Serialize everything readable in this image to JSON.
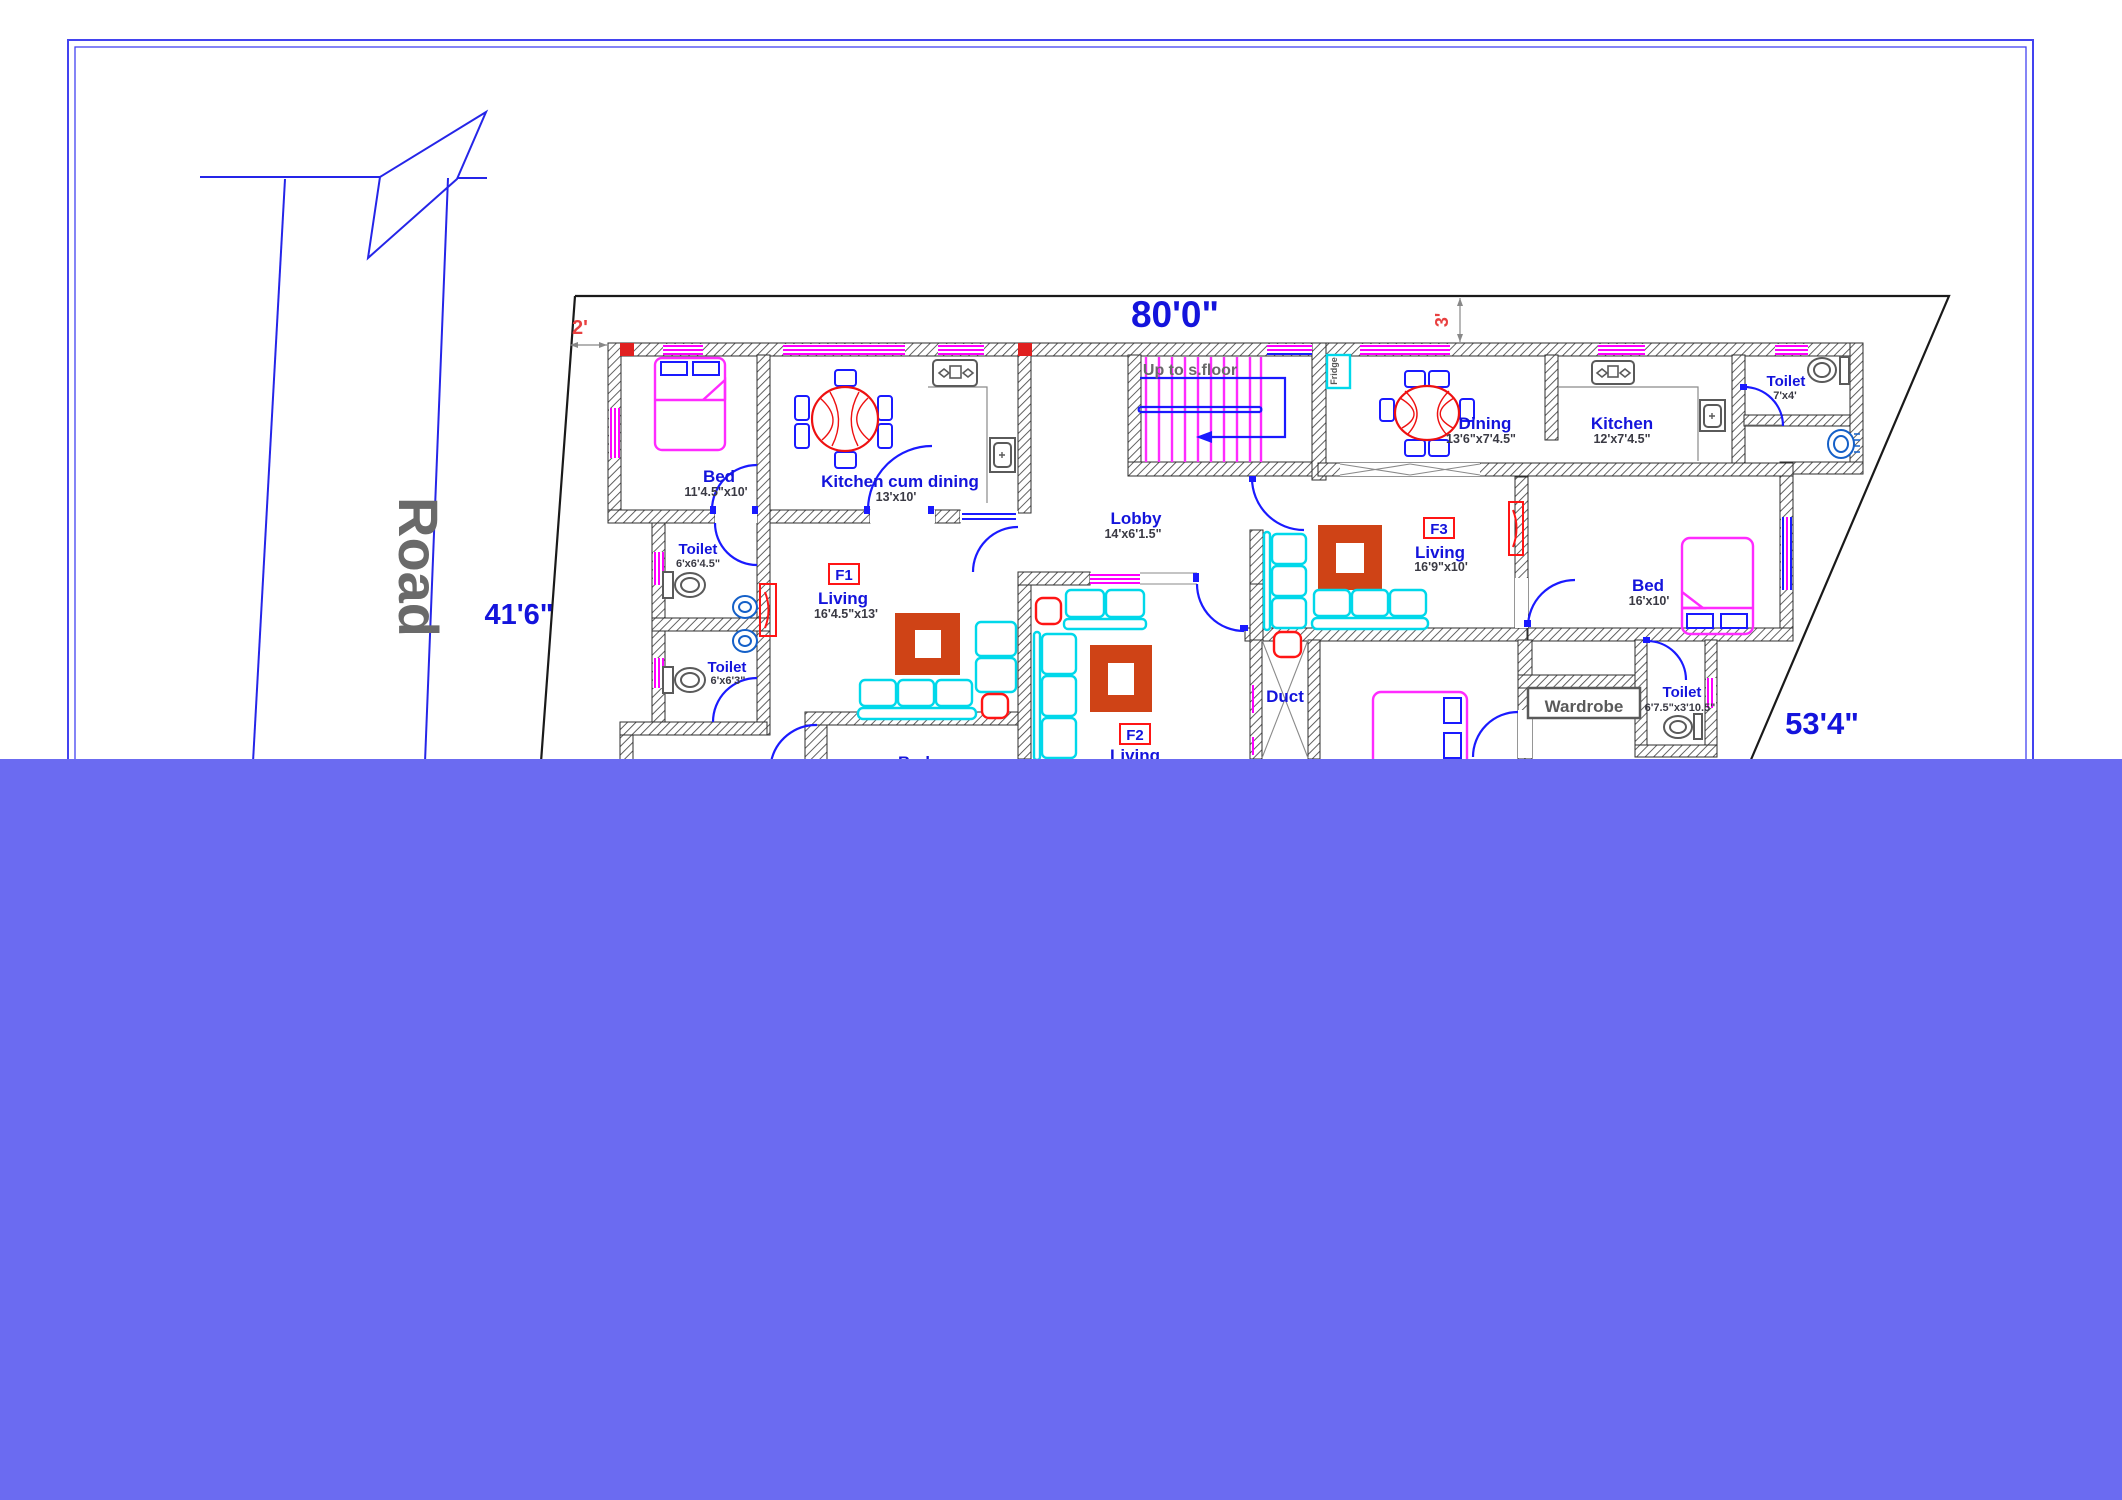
{
  "drawing": {
    "type": "architectural-floor-plan",
    "road_label": "Road",
    "stair_label": "Up to s.floor"
  },
  "dimensions": {
    "plot_top": "80'0\"",
    "plot_left": "41'6\"",
    "plot_right": "53'4\"",
    "setback_left": "2'",
    "setback_top": "3'"
  },
  "flats": {
    "f1": "F1",
    "f2": "F2",
    "f3": "F3"
  },
  "rooms": {
    "bed1": {
      "name": "Bed",
      "size": "11'4.5\"x10'"
    },
    "toilet1": {
      "name": "Toilet",
      "size": "6'x6'4.5\""
    },
    "toilet2": {
      "name": "Toilet",
      "size": "6'x6'3\""
    },
    "kitchen_cum_dining": {
      "name": "Kitchen cum dining",
      "size": "13'x10'"
    },
    "living_f1": {
      "name": "Living",
      "size": "16'4.5\"x13'"
    },
    "lobby": {
      "name": "Lobby",
      "size": "14'x6'1.5\""
    },
    "living_f2": {
      "name": "Living"
    },
    "dining": {
      "name": "Dining",
      "size": "13'6\"x7'4.5\""
    },
    "kitchen": {
      "name": "Kitchen",
      "size": "12'x7'4.5\""
    },
    "toilet3": {
      "name": "Toilet",
      "size": "7'x4'"
    },
    "bed2": {
      "name": "Bed",
      "size": "16'x10'"
    },
    "living_f3": {
      "name": "Living",
      "size": "16'9\"x10'"
    },
    "duct": {
      "name": "Duct"
    },
    "wardrobe": {
      "name": "Wardrobe"
    },
    "toilet4": {
      "name": "Toilet",
      "size": "6'7.5\"x3'10.5\""
    },
    "bed3": {
      "name": "Bed"
    },
    "bed4": {
      "name": "Bed"
    },
    "fridge": {
      "name": "Fridge"
    }
  },
  "colors": {
    "overlay": "#6b6bf1",
    "page_border": "#4343f0",
    "plot_line": "#1a1a1a",
    "blue_text": "#1414dc",
    "red_dim": "#e84040",
    "magenta": "#ff2bff",
    "cyan": "#00d8ea",
    "red": "#ff1515",
    "carpet": "#cf4316",
    "gray_text": "#6a6a6a"
  }
}
